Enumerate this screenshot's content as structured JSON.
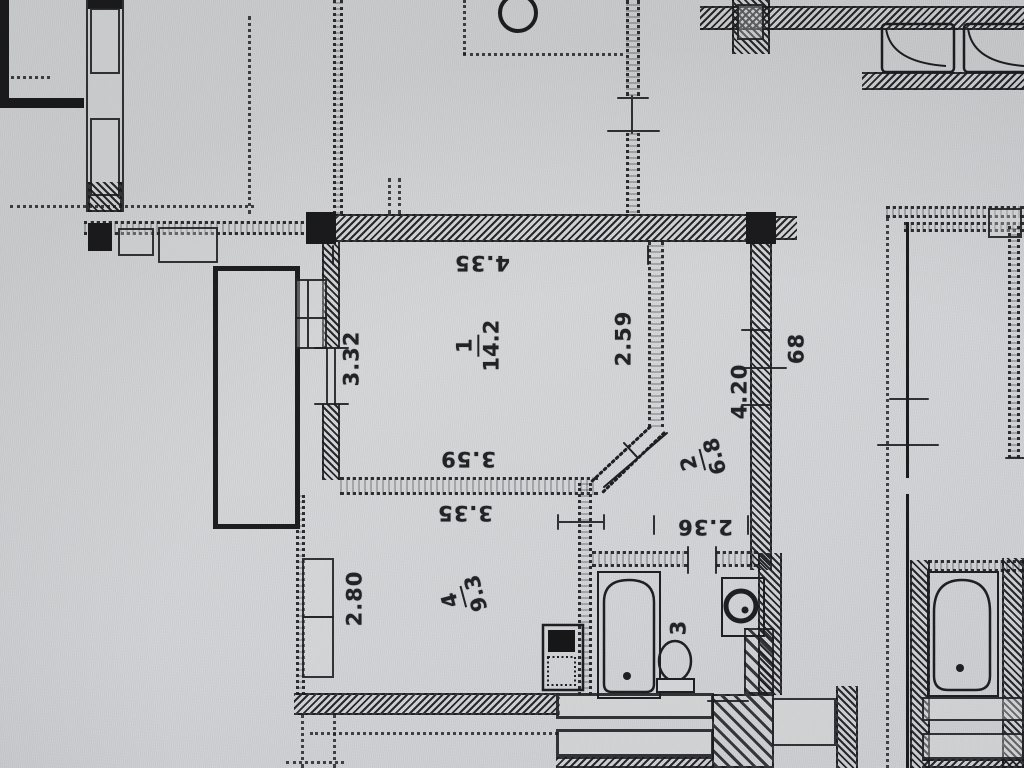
{
  "plan": {
    "colors": {
      "paper": "#d3d4d7",
      "ink": "#222226"
    },
    "rooms": [
      {
        "number": "1",
        "area": "14.2"
      },
      {
        "number": "2",
        "area": "6.8"
      },
      {
        "number": "3"
      },
      {
        "number": "4",
        "area": "9.3"
      }
    ],
    "dimensions": {
      "room1_top": "4.35",
      "room1_left": "3.32",
      "room1_right": "2.59",
      "room1_bottom": "3.59",
      "room4_top": "3.35",
      "room4_left": "2.80",
      "hall_right": "4.20",
      "bath_width": "2.36",
      "duct": "68"
    }
  }
}
